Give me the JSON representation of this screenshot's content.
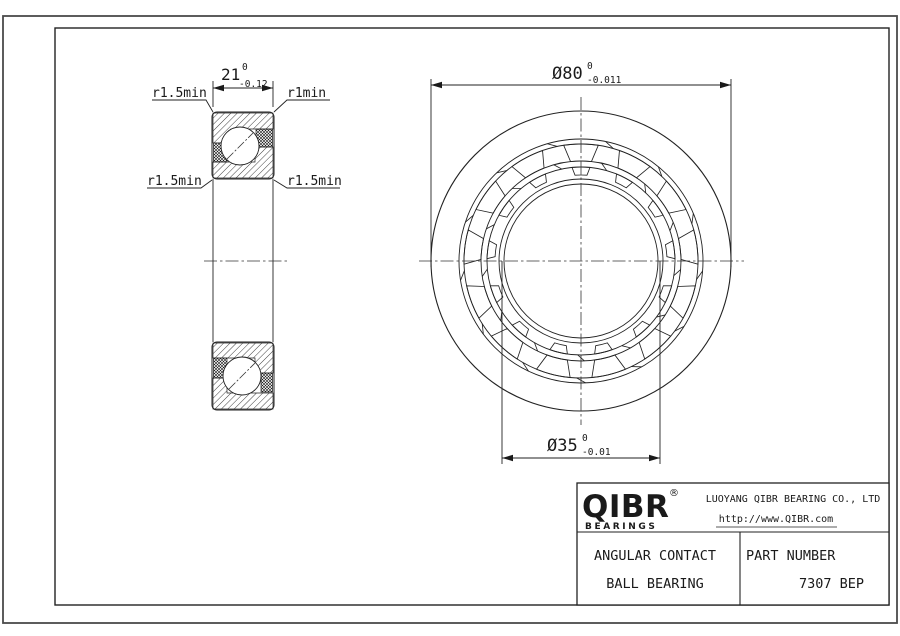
{
  "left_view": {
    "width_dimension": {
      "value": "21",
      "tol_upper": "0",
      "tol_lower": "-0.12"
    },
    "radius_labels": {
      "top_left": "r1.5min",
      "top_right": "r1min",
      "bottom_left": "r1.5min",
      "bottom_right": "r1.5min"
    }
  },
  "front_view": {
    "outer_diameter_dimension": {
      "value": "Ø80",
      "tol_upper": "0",
      "tol_lower": "-0.011"
    },
    "bore_diameter_dimension": {
      "value": "Ø35",
      "tol_upper": "0",
      "tol_lower": "-0.01"
    },
    "geometry": {
      "cx": 581,
      "cy": 261,
      "circle_radii": [
        150,
        122,
        117,
        100,
        94,
        82,
        77
      ],
      "ball_count": 13,
      "pocket_outer_r": 117,
      "pocket_inner_r": 100,
      "small_outer_r": 94,
      "small_inner_r": 86,
      "tick_outer_band": [
        122,
        117
      ],
      "tick_inner_band": [
        100,
        94
      ]
    }
  },
  "title_block": {
    "brand": "QIBR",
    "registered_mark": "®",
    "brand_sub": "BEARINGS",
    "company": "LUOYANG QIBR BEARING CO., LTD",
    "website": "http://www.QIBR.com",
    "product_type_line1": "ANGULAR CONTACT",
    "product_type_line2": "BALL BEARING",
    "part_number_label": "PART NUMBER",
    "part_number": "7307 BEP"
  }
}
